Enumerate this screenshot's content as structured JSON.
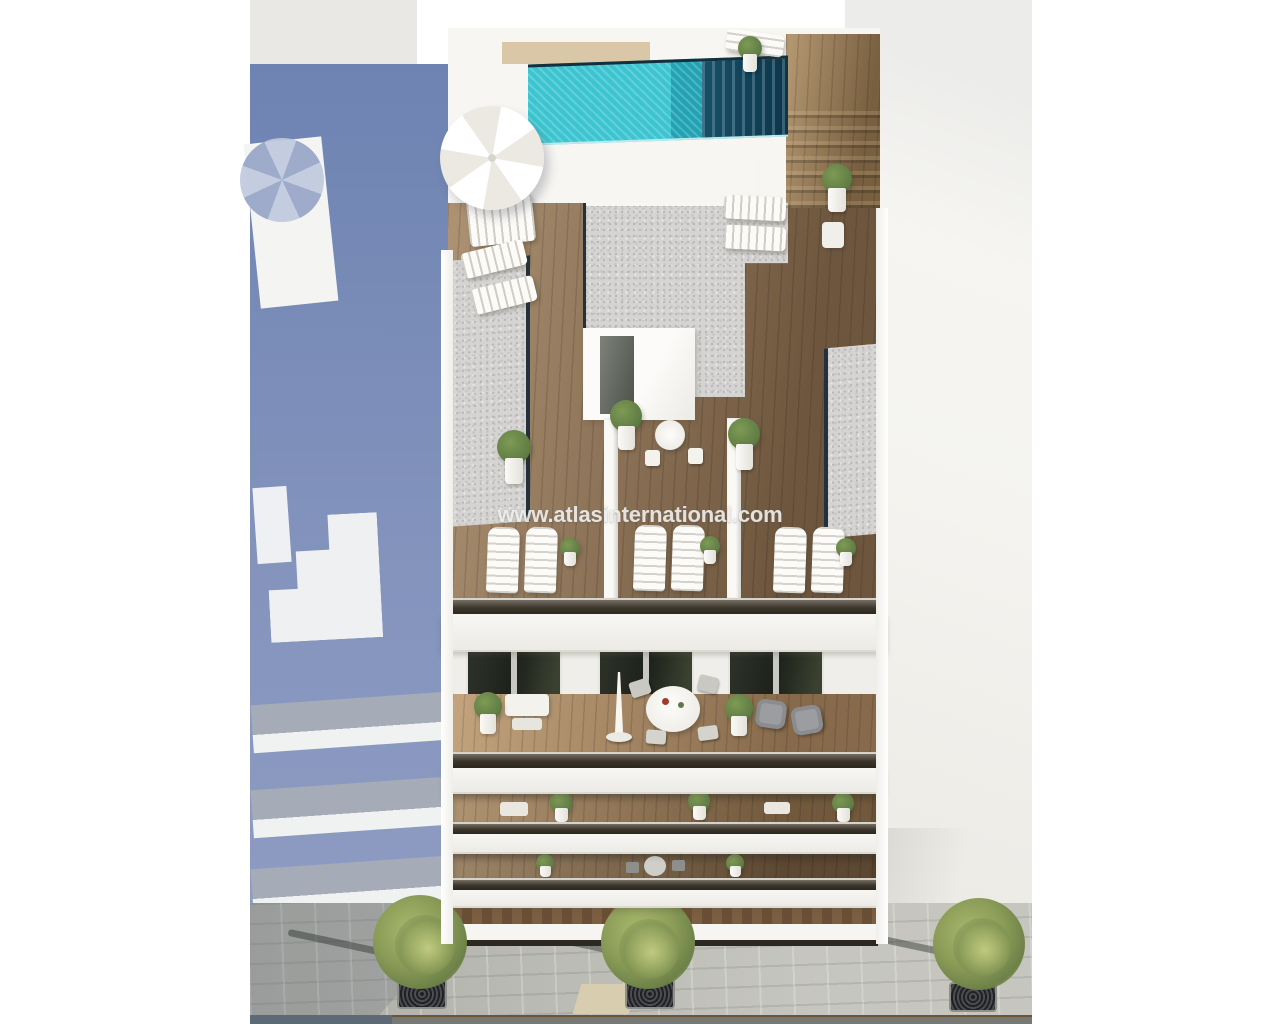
{
  "watermark": {
    "text": "www.atlasinternational.com"
  },
  "colors": {
    "band-gray": "#e9e8e4",
    "shadow-blue": "#6e83b2",
    "shadow-blue-light": "#8e9cc2",
    "pool-turquoise": "#3cc5d0",
    "pool-turquoise-deep": "#21a3b4",
    "pool-dark": "#175069",
    "wood-light": "#a98a66",
    "wood-mid": "#8a6c4e",
    "wood-dark": "#6f5338",
    "sand-wood": "#d9c7a7",
    "gravel": "#d5d4d2",
    "white-wall": "#f7f6f3",
    "right-plane": "#f4f3ef",
    "glass-dark": "#37312a",
    "window-dark": "#262b23",
    "plant-green": "#5f7c44",
    "plant-green-light": "#7e9a55",
    "pavement": "#b7b8b2",
    "road": "#777a74",
    "slab-gray": "#a5abb7",
    "coping-dark": "#22313d"
  }
}
